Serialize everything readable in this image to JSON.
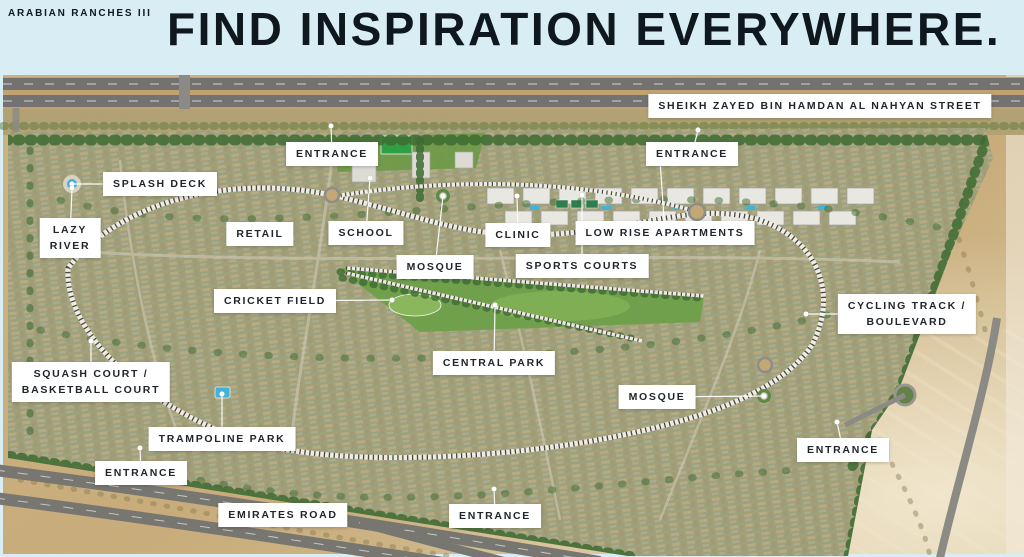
{
  "header": {
    "brand": "ARABIAN RANCHES III",
    "headline": "FIND INSPIRATION EVERYWHERE."
  },
  "colors": {
    "header_bg": "#d9edf5",
    "headline_text": "#10181f",
    "label_bg": "#ffffff",
    "label_text": "#20262c",
    "sand": "#cdb183",
    "development": "#a0a17c",
    "park_green": "#70a04b",
    "tree_green": "#3e6b33",
    "pitch_green": "#2f9e44",
    "road_gray": "#787670",
    "water_blue": "#42b2d6",
    "leader_white": "#ffffff"
  },
  "map": {
    "labels": [
      {
        "name": "label-sheikh-zayed-street",
        "lines": [
          "SHEIKH ZAYED BIN HAMDAN AL NAHYAN STREET"
        ],
        "x": 820,
        "y": 106,
        "dot": null
      },
      {
        "name": "label-entrance-top-left",
        "lines": [
          "ENTRANCE"
        ],
        "x": 332,
        "y": 154,
        "dot": [
          331,
          126
        ]
      },
      {
        "name": "label-entrance-top-right",
        "lines": [
          "ENTRANCE"
        ],
        "x": 692,
        "y": 154,
        "dot": [
          698,
          130
        ]
      },
      {
        "name": "label-splash-deck",
        "lines": [
          "SPLASH DECK"
        ],
        "x": 160,
        "y": 184,
        "dot": [
          72,
          184
        ]
      },
      {
        "name": "label-lazy-river",
        "lines": [
          "LAZY",
          "RIVER"
        ],
        "x": 70,
        "y": 238,
        "dot": [
          72,
          188
        ]
      },
      {
        "name": "label-retail",
        "lines": [
          "RETAIL"
        ],
        "x": 260,
        "y": 234,
        "dot": null
      },
      {
        "name": "label-school",
        "lines": [
          "SCHOOL"
        ],
        "x": 366,
        "y": 233,
        "dot": [
          370,
          178
        ]
      },
      {
        "name": "label-clinic",
        "lines": [
          "CLINIC"
        ],
        "x": 518,
        "y": 235,
        "dot": [
          517,
          196
        ]
      },
      {
        "name": "label-low-rise-apartments",
        "lines": [
          "LOW RISE APARTMENTS"
        ],
        "x": 665,
        "y": 233,
        "dot": [
          660,
          160
        ]
      },
      {
        "name": "label-mosque-north",
        "lines": [
          "MOSQUE"
        ],
        "x": 435,
        "y": 267,
        "dot": [
          443,
          196
        ]
      },
      {
        "name": "label-sports-courts",
        "lines": [
          "SPORTS COURTS"
        ],
        "x": 582,
        "y": 266,
        "dot": [
          582,
          195
        ]
      },
      {
        "name": "label-cricket-field",
        "lines": [
          "CRICKET FIELD"
        ],
        "x": 275,
        "y": 301,
        "dot": [
          392,
          300
        ]
      },
      {
        "name": "label-central-park",
        "lines": [
          "CENTRAL PARK"
        ],
        "x": 494,
        "y": 363,
        "dot": [
          495,
          305
        ]
      },
      {
        "name": "label-cycling-track",
        "lines": [
          "CYCLING TRACK /",
          "BOULEVARD"
        ],
        "x": 907,
        "y": 314,
        "dot": [
          806,
          314
        ]
      },
      {
        "name": "label-squash-basketball",
        "lines": [
          "SQUASH COURT /",
          "BASKETBALL COURT"
        ],
        "x": 91,
        "y": 382,
        "dot": [
          91,
          341
        ]
      },
      {
        "name": "label-mosque-south",
        "lines": [
          "MOSQUE"
        ],
        "x": 657,
        "y": 397,
        "dot": [
          764,
          396
        ]
      },
      {
        "name": "label-trampoline-park",
        "lines": [
          "TRAMPOLINE PARK"
        ],
        "x": 222,
        "y": 439,
        "dot": [
          222,
          394
        ]
      },
      {
        "name": "label-entrance-west",
        "lines": [
          "ENTRANCE"
        ],
        "x": 141,
        "y": 473,
        "dot": [
          140,
          448
        ]
      },
      {
        "name": "label-entrance-east",
        "lines": [
          "ENTRANCE"
        ],
        "x": 843,
        "y": 450,
        "dot": [
          837,
          422
        ]
      },
      {
        "name": "label-emirates-road",
        "lines": [
          "EMIRATES ROAD"
        ],
        "x": 283,
        "y": 515,
        "dot": null
      },
      {
        "name": "label-entrance-south",
        "lines": [
          "ENTRANCE"
        ],
        "x": 495,
        "y": 516,
        "dot": [
          494,
          489
        ]
      }
    ]
  }
}
